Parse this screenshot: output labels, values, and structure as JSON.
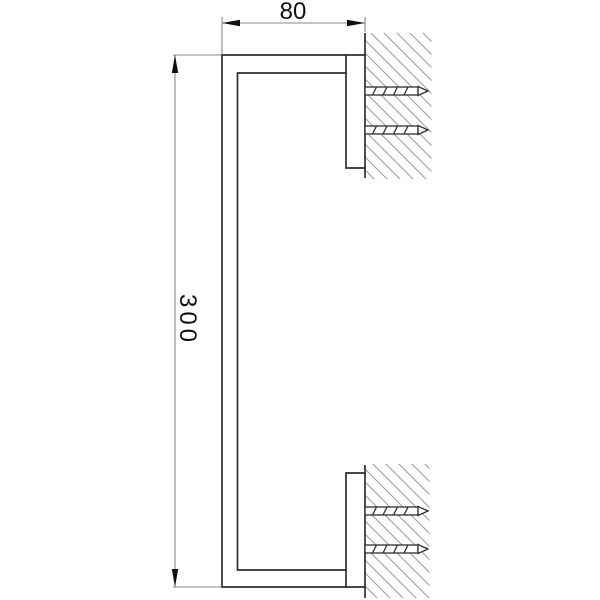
{
  "drawing": {
    "dimensions": {
      "width": "80",
      "height": "300"
    },
    "colors": {
      "outline": "#2f2f2f",
      "dimension_line": "#8a8a8a",
      "arrow_fill": "#111111",
      "hatch": "#9e9e9e",
      "text": "#111111",
      "background": "#ffffff"
    }
  }
}
